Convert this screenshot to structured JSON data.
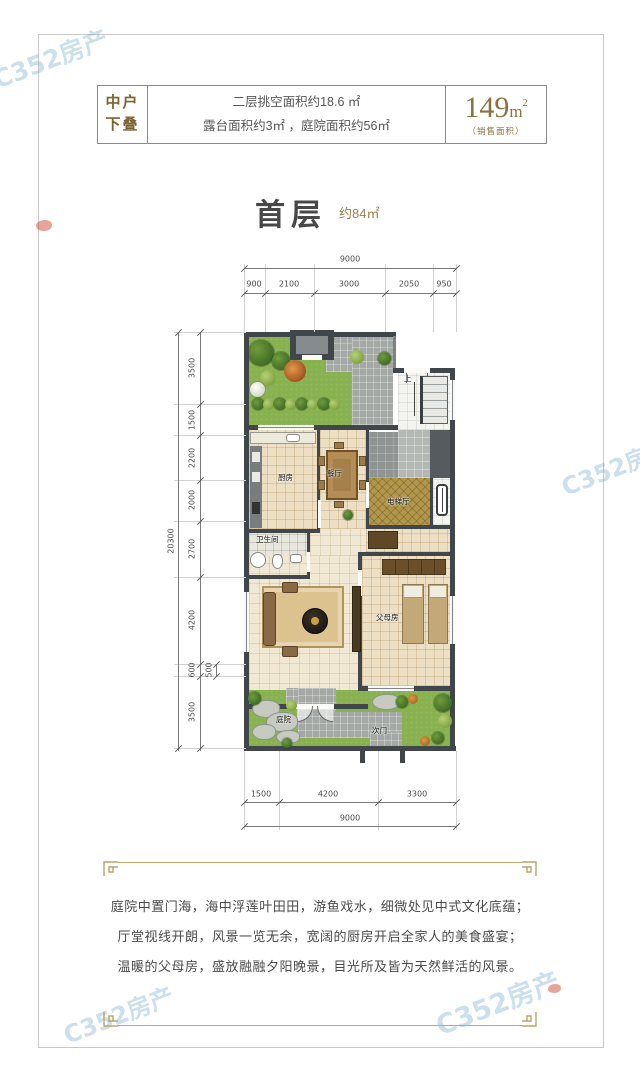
{
  "watermark": {
    "text": "C352房产"
  },
  "header": {
    "unit_tag": {
      "line1": "中户",
      "line2": "下叠"
    },
    "area_desc": {
      "line1": "二层挑空面积约18.6 ㎡",
      "line2": "露台面积约3㎡ ，庭院面积约56㎡"
    },
    "area_badge": {
      "value": "149",
      "unit": "m",
      "sup": "2",
      "note": "（销售面积）"
    }
  },
  "title": {
    "main": "首层",
    "sub": "约84㎡"
  },
  "plan": {
    "labels": {
      "kitchen": "厨房",
      "dining": "餐厅",
      "elevator_hall": "电梯厅",
      "bathroom": "卫生间",
      "parents": "父母房",
      "courtyard": "庭院",
      "side_door": "次门",
      "stairs_up": "上"
    },
    "dims": {
      "top_total": "9000",
      "top_segments": [
        "900",
        "2100",
        "3000",
        "2050",
        "950"
      ],
      "left_total": "20300",
      "left_segments": [
        "3500",
        "1500",
        "2200",
        "2000",
        "2700",
        "4200",
        "600",
        "3500"
      ],
      "left_inner": "500",
      "bottom_segments": [
        "1500",
        "4200",
        "3300"
      ],
      "bottom_total": "9000"
    }
  },
  "description": {
    "lines": [
      "庭院中置门海，海中浮莲叶田田，游鱼戏水，细微处见中式文化底蕴；",
      "厅堂视线开朗，风景一览无余，宽阔的厨房开启全家人的美食盛宴；",
      "温暖的父母房，盛放融融夕阳晚景，目光所及皆为天然鲜活的风景。"
    ]
  },
  "colors": {
    "accent_gold": "#9c8049",
    "wall": "#41464a",
    "grass": "#88b150",
    "paving": "#a4a9a6"
  }
}
